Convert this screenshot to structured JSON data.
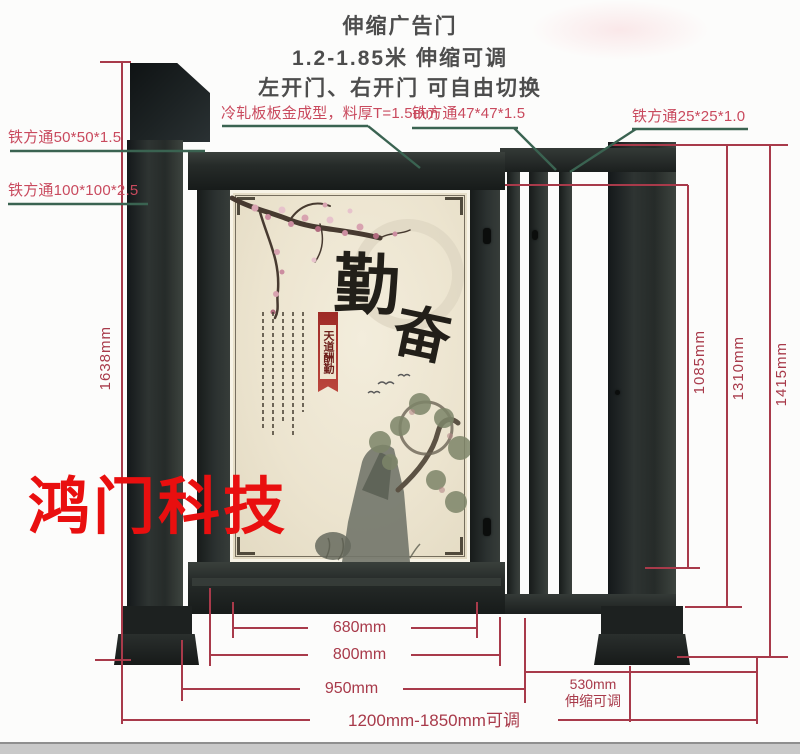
{
  "header": {
    "title": "伸缩广告门",
    "subtitle": "1.2-1.85米 伸缩可调",
    "note": "左开门、右开门 可自由切换"
  },
  "callouts": {
    "tube_50": "铁方通50*50*1.5",
    "tube_100": "铁方通100*100*2.5",
    "cold_rolled_panel": "冷轧板板金成型，料厚T=1.5mm",
    "tube_47": "铁方通47*47*1.5",
    "tube_25": "铁方通25*25*1.0"
  },
  "dimensions": {
    "left_total_height": "1638mm",
    "inner_height": "1085mm",
    "mid_height": "1310mm",
    "outer_height": "1415mm",
    "poster_width": "680mm",
    "door_width": "800mm",
    "frame_width": "950mm",
    "telescopic_width": "530mm",
    "telescopic_note": "伸缩可调",
    "overall_range": "1200mm-1850mm可调"
  },
  "poster": {
    "char_main_1": "勤",
    "char_main_2": "奋",
    "banner_text": "天道酬勤"
  },
  "watermark": "鸿门科技",
  "colors": {
    "dimension_red": "#a83a4a",
    "label_red": "#c94a5e",
    "leader_green": "#3a6351",
    "gate_dark": "#262b29",
    "poster_cream": "#ece4cf",
    "watermark_red": "#e90f0f"
  }
}
